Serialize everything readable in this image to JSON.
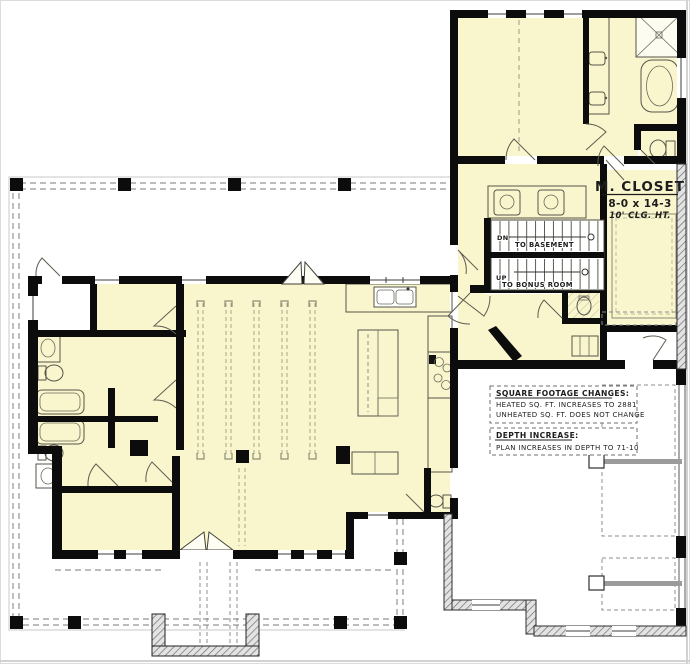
{
  "plan": {
    "closet": {
      "title": "M. CLOSET",
      "dims": "8-0 x 14-3",
      "ceiling": "10' CLG. HT."
    },
    "stairs": {
      "dn": "DN",
      "dn_dest": "TO BASEMENT",
      "up": "UP",
      "up_dest": "TO BONUS ROOM"
    },
    "notes": {
      "sqft_title": "SQUARE FOOTAGE CHANGES:",
      "sqft_line1": "HEATED SQ. FT. INCREASES TO 2881",
      "sqft_line2": "UNHEATED SQ. FT. DOES NOT CHANGE",
      "depth_title": "DEPTH INCREASE:",
      "depth_line1": "PLAN INCREASES IN DEPTH TO 71-10"
    },
    "colors": {
      "heated": "#f9f6cd",
      "wall": "#0c0c0c",
      "dash": "#949494",
      "fixture": "#55544a",
      "track": "#9b9b9b"
    }
  }
}
